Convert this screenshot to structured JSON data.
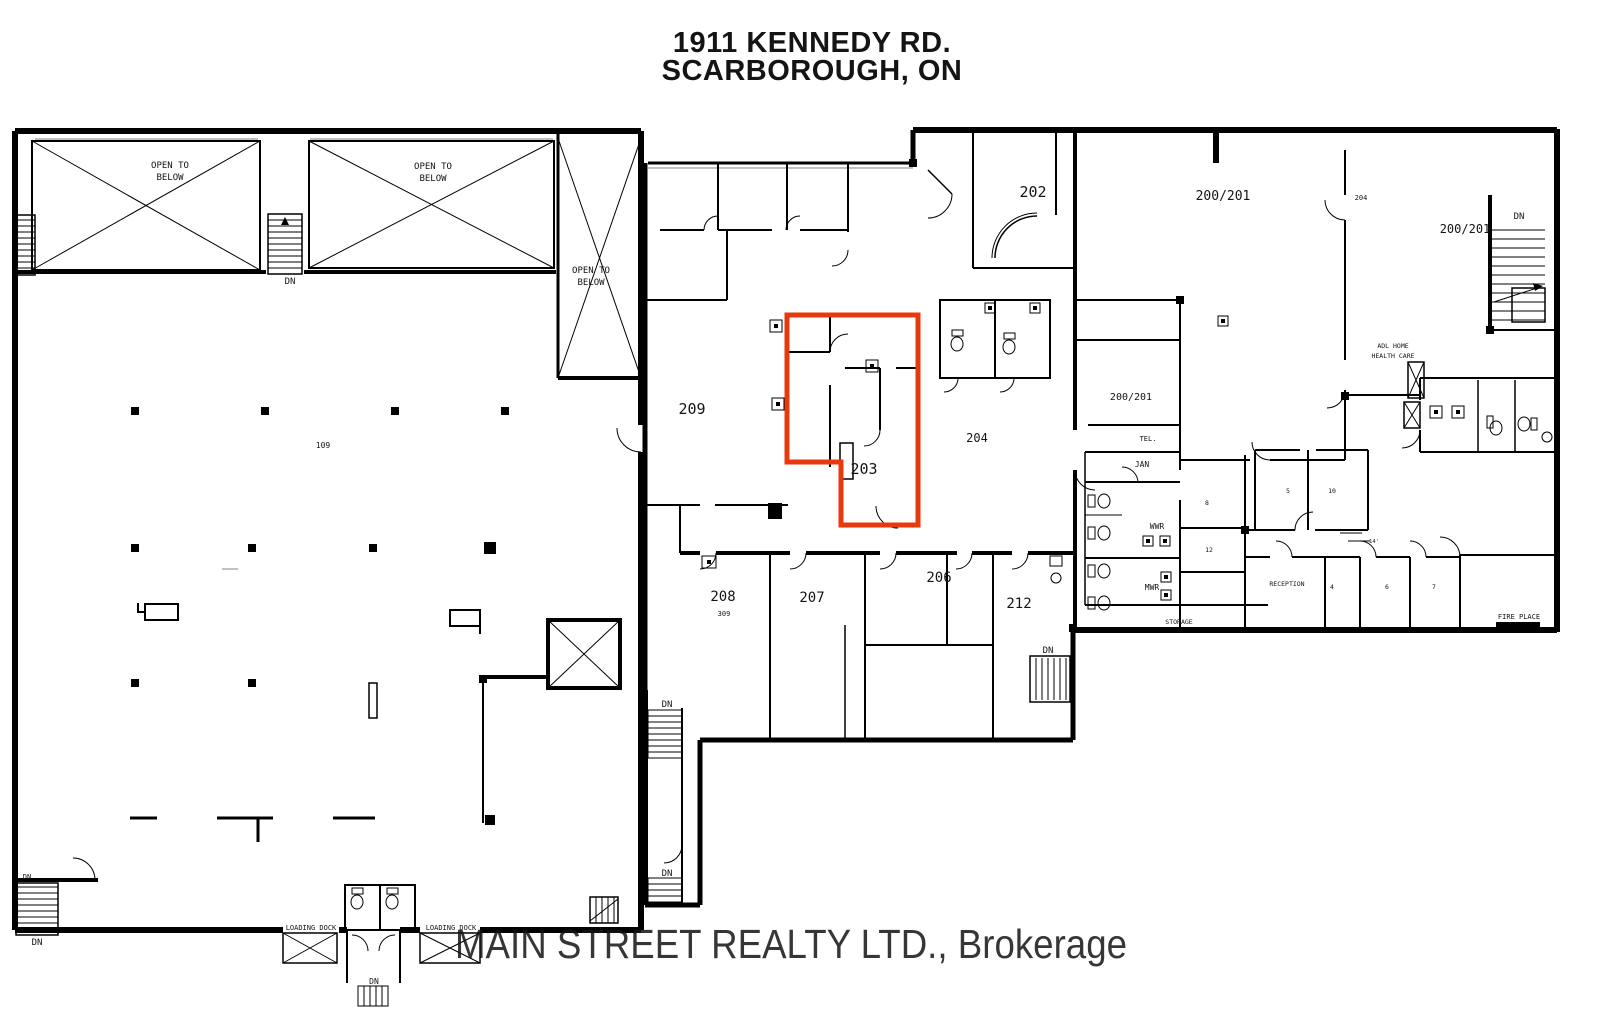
{
  "title": {
    "line1": "1911 KENNEDY RD.",
    "line2": "SCARBOROUGH, ON"
  },
  "watermark": {
    "text": "MAIN STREET REALTY LTD., Brokerage",
    "color": "#c6c6c6"
  },
  "colors": {
    "highlight": "#e8380d",
    "wall": "#000000"
  },
  "highlighted_unit": "203",
  "units": {
    "u109": "109",
    "u200_201": "200/201",
    "u202": "202",
    "u203": "203",
    "u204": "204",
    "u204_small": "204",
    "u206": "206",
    "u207": "207",
    "u208": "208",
    "u208_area": "309",
    "u209": "209",
    "u212": "212"
  },
  "rooms": {
    "tel": "TEL.",
    "jan": "JAN",
    "wwr": "WWR",
    "mwr": "MWR",
    "storage": "STORAGE",
    "reception": "RECEPTION",
    "adl_line1": "ADL HOME",
    "adl_line2": "HEALTH CARE",
    "fire_place": "FIRE PLACE",
    "small_1": "8",
    "small_2": "12",
    "small_3": "5",
    "small_4": "10",
    "small_5": "4",
    "small_6": "6",
    "small_7": "7",
    "dim": "14'"
  },
  "annotations": {
    "open_to": "OPEN TO",
    "below": "BELOW",
    "dn": "DN",
    "loading_dock": "LOADING DOCK"
  }
}
